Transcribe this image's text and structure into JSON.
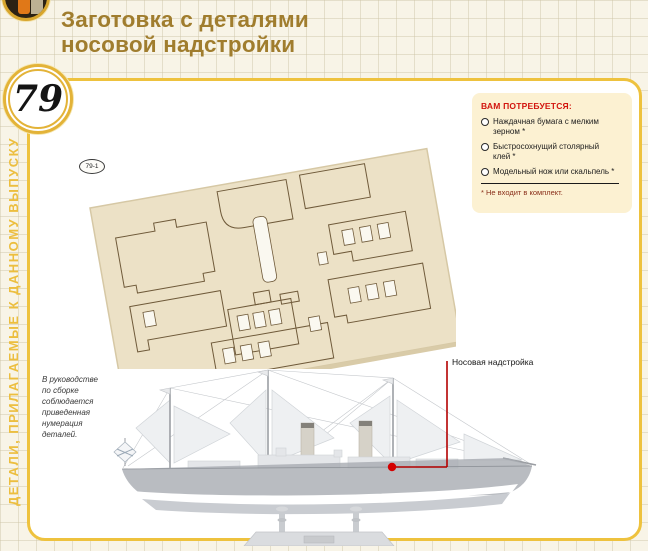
{
  "page": {
    "issue_badge": "79",
    "title": "Заготовка с деталями\nносовой надстройки",
    "sidebar_label": "ДЕТАЛИ, ПРИЛАГАЕМЫЕ К ДАННОМУ ВЫПУСКУ",
    "sheet_tag": "79-1"
  },
  "requirements": {
    "heading": "ВАМ ПОТРЕБУЕТСЯ:",
    "items": [
      {
        "label": "Наждачная бумага с мелким\nзерном *"
      },
      {
        "label": "Быстросохнущий столярный\nклей *"
      },
      {
        "label": "Модельный нож или скальпель *"
      }
    ],
    "footnote": "* Не входит в комплект."
  },
  "note_text": "В руководстве\nпо сборке\nсоблюдается\nприведенная\nнумерация\nдеталей.",
  "callout_label": "Носовая надстройка",
  "colors": {
    "accent_gold": "#eec23e",
    "title_brown": "#a07d2e",
    "heading_red": "#d2150e",
    "callout_red": "#c00000",
    "panel_cream": "#fcf1d2"
  }
}
